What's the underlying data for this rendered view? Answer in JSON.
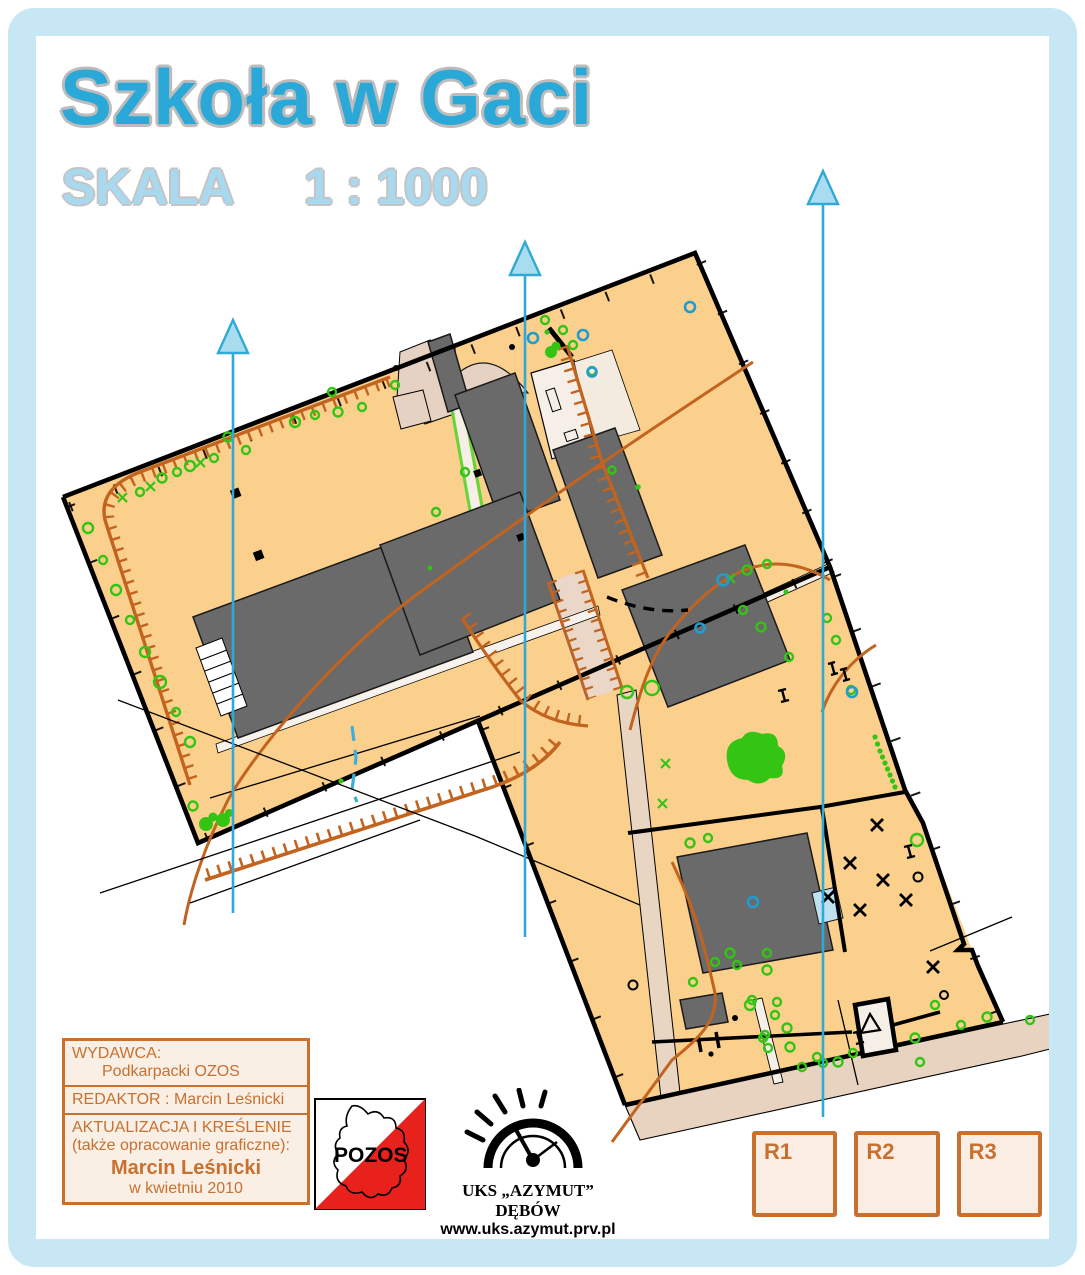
{
  "page": {
    "background": "#ffffff",
    "frame_color": "#C7E7F5"
  },
  "header": {
    "title": "Szkoła w Gaci",
    "title_color": "#2AA9D9",
    "scale_label": "SKALA",
    "scale_value": "1 : 1000",
    "scale_color": "#A9D9EF"
  },
  "credits": {
    "publisher_label": "WYDAWCA:",
    "publisher": "Podkarpacki OZOS",
    "editor": "REDAKTOR : Marcin Leśnicki",
    "update_line1": "AKTUALIZACJA I KREŚLENIE",
    "update_line2": "(także opracowanie graficzne):",
    "author": "Marcin Leśnicki",
    "date": "w kwietniu 2010",
    "accent_color": "#C8702F"
  },
  "logos": {
    "pozos": {
      "text": "POZOS",
      "flag_red": "#E8211D"
    },
    "azymut": {
      "name": "UKS „AZYMUT” DĘBÓW",
      "url": "www.uks.azymut.prv.pl"
    }
  },
  "reserve_boxes": [
    {
      "label": "R1"
    },
    {
      "label": "R2"
    },
    {
      "label": "R3"
    }
  ],
  "map_colors": {
    "open_land": "#FBD08C",
    "building": "#6A6A6A",
    "paved": "#EDDACA",
    "road": "#E7D3BF",
    "earth_line": "#C2641F",
    "north_line": "#2FA9D6",
    "vegetation": "#33C414",
    "water": "#1F9CD0"
  }
}
